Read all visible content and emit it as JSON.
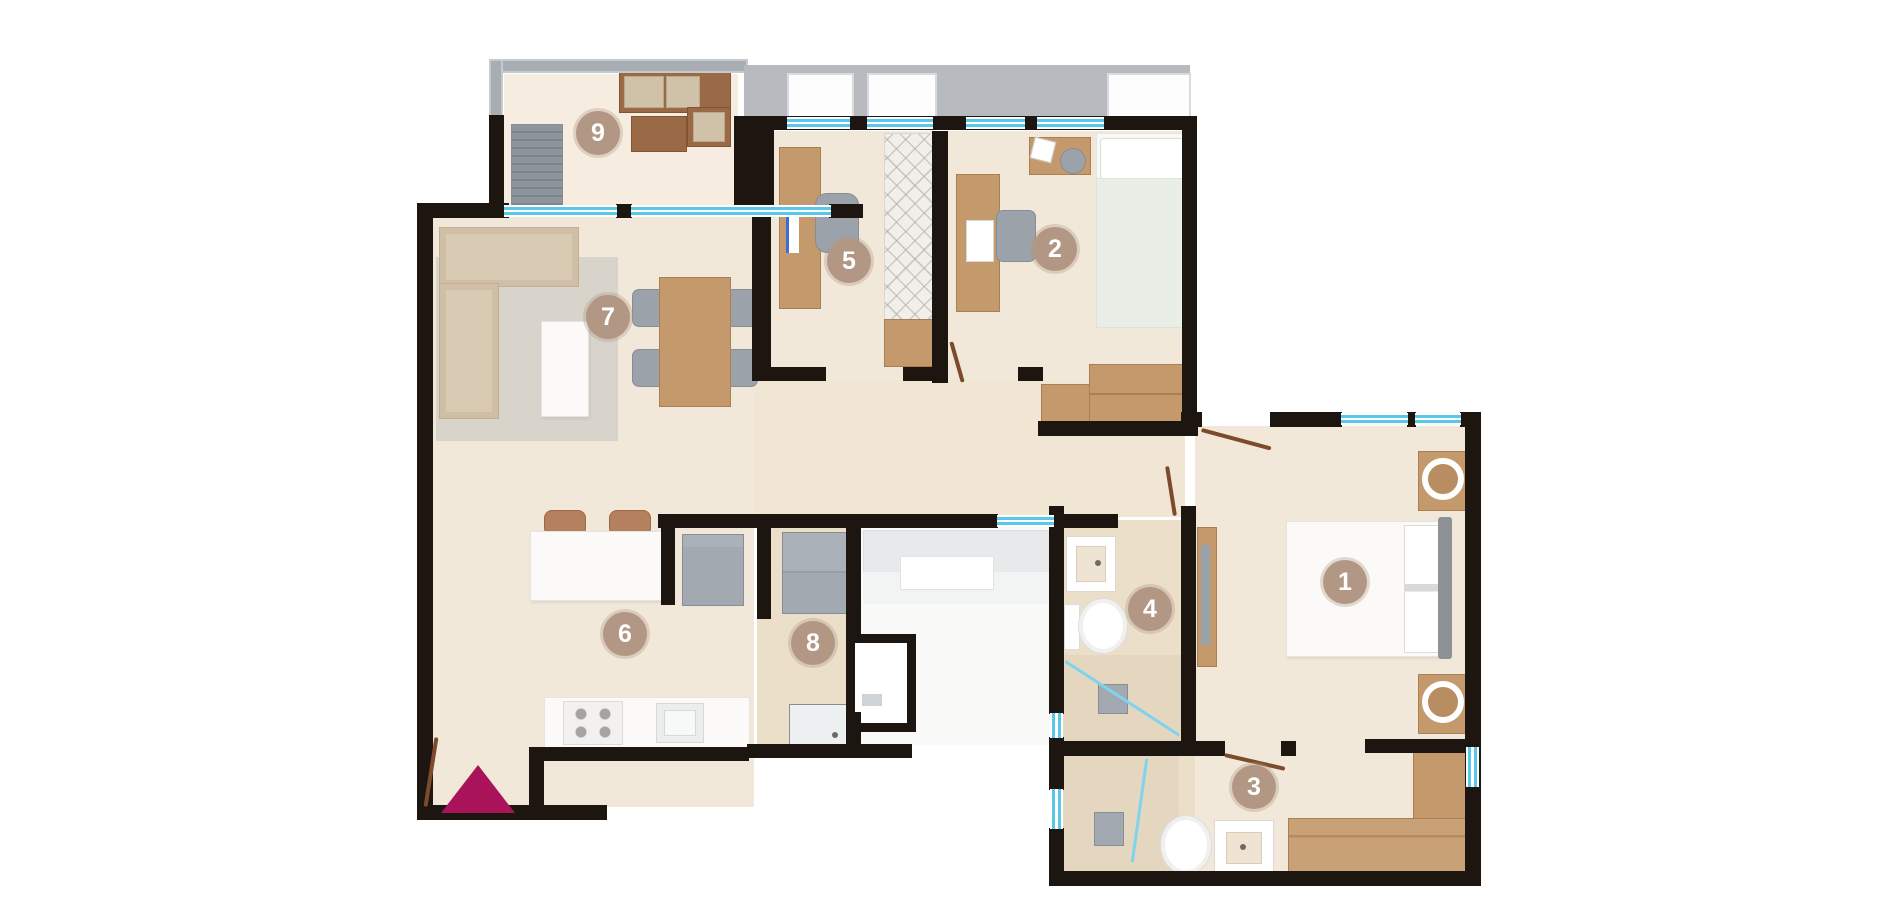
{
  "plan": {
    "rooms": [
      {
        "label": "1"
      },
      {
        "label": "2"
      },
      {
        "label": "3"
      },
      {
        "label": "4"
      },
      {
        "label": "5"
      },
      {
        "label": "6"
      },
      {
        "label": "7"
      },
      {
        "label": "8"
      },
      {
        "label": "9"
      }
    ],
    "colors": {
      "wall": "#1d150f",
      "floor": "#f2e8da",
      "floor_dark": "#ebdfc9",
      "corridor": "#f9f9f8",
      "window": "#58c7e8",
      "terrace": "#b7bbc0",
      "badge": "#b29784",
      "badge_text": "#ffffff",
      "entrance_marker": "#a9135a",
      "wood": "#c49a6d",
      "wood_dark": "#9a6a47",
      "appliance": "#a2a9b0",
      "sofa": "#d9cab3",
      "rug": "#d5d0c8",
      "tile": "#e5d7bf"
    },
    "marker": {
      "shape": "triangle",
      "direction": "up"
    }
  }
}
